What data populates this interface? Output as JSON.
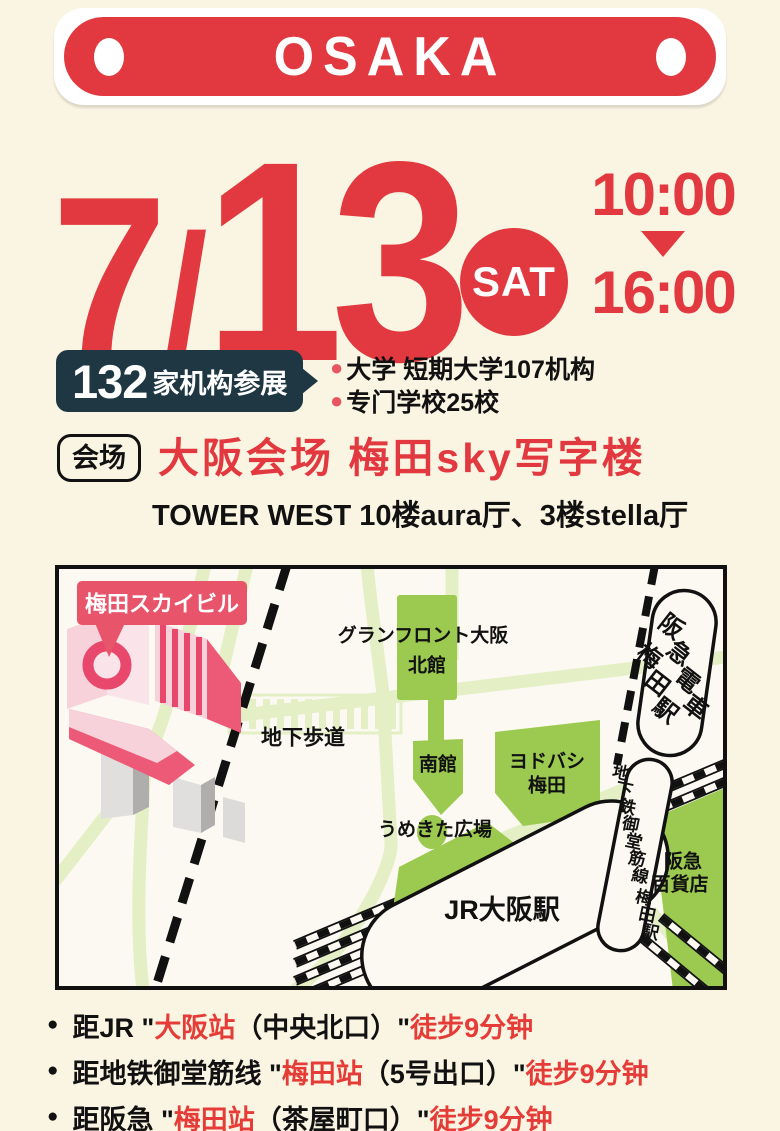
{
  "colors": {
    "cream_bg": "#FAF4E2",
    "accent_red": "#E23940",
    "badge_navy": "#1E3742",
    "bullet_red": "#E75560",
    "map_green": "#9CC94F",
    "map_road": "#E4EFC5",
    "map_bg": "#FBF9F1",
    "tag_red": "#E8546A",
    "access_red": "#E63C38",
    "ink": "#111111"
  },
  "banner": {
    "title": "OSAKA"
  },
  "date": {
    "month": "7",
    "slash": "/",
    "day": "13",
    "weekday": "SAT",
    "time_start": "10:00",
    "time_end": "16:00"
  },
  "stats": {
    "count": "132",
    "count_suffix": "家机构参展",
    "bullet_glyph": "●",
    "items": [
      {
        "text": "大学 短期大学107机构"
      },
      {
        "text": "专门学校25校"
      }
    ]
  },
  "venue": {
    "label": "会场",
    "title": "大阪会场 梅田sky写字楼",
    "subtitle": "TOWER WEST 10楼aura厅、3楼stella厅"
  },
  "map": {
    "labels": [
      {
        "id": "umeda-sky-tag",
        "text": "梅田スカイビル",
        "x": 107,
        "y": 39,
        "size": 22,
        "weight": 800,
        "color": "#ffffff"
      },
      {
        "id": "chika-hodo",
        "text": "地下歩道",
        "x": 248,
        "y": 173,
        "size": 21,
        "weight": 700
      },
      {
        "id": "grand-front-osaka",
        "text": "グランフロント大阪",
        "x": 368,
        "y": 71,
        "size": 19,
        "weight": 700
      },
      {
        "id": "kitakan",
        "text": "北館",
        "x": 372,
        "y": 101,
        "size": 19,
        "weight": 700
      },
      {
        "id": "minamikan",
        "text": "南館",
        "x": 383,
        "y": 200,
        "size": 19,
        "weight": 700
      },
      {
        "id": "yodobashi-1",
        "text": "ヨドバシ",
        "x": 492,
        "y": 197,
        "size": 19,
        "weight": 700
      },
      {
        "id": "yodobashi-2",
        "text": "梅田",
        "x": 492,
        "y": 221,
        "size": 19,
        "weight": 700
      },
      {
        "id": "umekita-hiroba",
        "text": "うめきた広場",
        "x": 380,
        "y": 265,
        "size": 19,
        "weight": 700
      },
      {
        "id": "jr-osaka-station",
        "text": "JR大阪駅",
        "x": 447,
        "y": 345,
        "size": 27,
        "weight": 800
      },
      {
        "id": "hankyu-dept-1",
        "text": "阪急",
        "x": 628,
        "y": 297,
        "size": 19,
        "weight": 700
      },
      {
        "id": "hankyu-dept-2",
        "text": "百貨店",
        "x": 625,
        "y": 320,
        "size": 19,
        "weight": 700
      },
      {
        "id": "hankyu-station-1",
        "text": "阪急電車",
        "x": 616,
        "y": 62,
        "size": 24,
        "weight": 800,
        "vertical": true,
        "dx": 8,
        "dy": 27,
        "rot": 38
      },
      {
        "id": "hankyu-station-2",
        "text": "梅田駅",
        "x": 594,
        "y": 92,
        "size": 24,
        "weight": 800,
        "vertical": true,
        "dx": 8,
        "dy": 27,
        "rot": 38
      },
      {
        "id": "midosuji-line-1",
        "text": "地下鉄御堂筋線",
        "x": 566,
        "y": 208,
        "size": 17,
        "weight": 700,
        "vertical": true,
        "dx": 3.2,
        "dy": 17.2,
        "rot": 12
      },
      {
        "id": "midosuji-line-2",
        "text": "梅田駅",
        "x": 589,
        "y": 333,
        "size": 17,
        "weight": 700,
        "vertical": true,
        "dx": 3.2,
        "dy": 17.2,
        "rot": 12
      }
    ]
  },
  "access": {
    "bullet_glyph": "●",
    "items": [
      {
        "segments": [
          {
            "t": "距JR \"",
            "c": "k"
          },
          {
            "t": "大阪站",
            "c": "r"
          },
          {
            "t": "（中央北口）\"",
            "c": "k"
          },
          {
            "t": " 徒步9分钟",
            "c": "r"
          }
        ]
      },
      {
        "segments": [
          {
            "t": "距地铁御堂筋线 \"",
            "c": "k"
          },
          {
            "t": "梅田站",
            "c": "r"
          },
          {
            "t": "（5号出口）\"",
            "c": "k"
          },
          {
            "t": " 徒步9分钟",
            "c": "r"
          }
        ]
      },
      {
        "segments": [
          {
            "t": "距阪急 \"",
            "c": "k"
          },
          {
            "t": "梅田站",
            "c": "r"
          },
          {
            "t": "（茶屋町口）\"",
            "c": "k"
          },
          {
            "t": " 徒步9分钟",
            "c": "r"
          }
        ]
      }
    ]
  }
}
